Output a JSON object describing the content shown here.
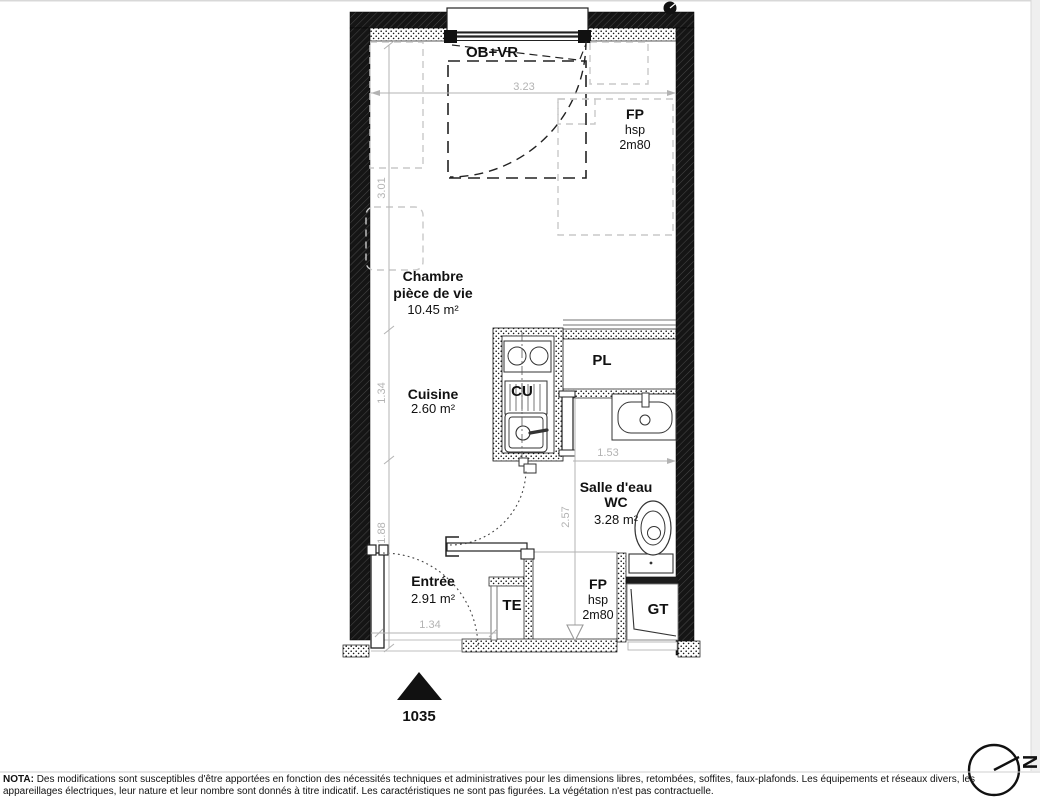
{
  "plan": {
    "unit": {
      "number": "1035"
    },
    "rooms": {
      "chambre": {
        "name": "Chambre",
        "sub": "pièce de vie",
        "area": "10.45 m²"
      },
      "cuisine": {
        "name": "Cuisine",
        "area": "2.60 m²"
      },
      "salle_eau": {
        "name": "Salle d'eau",
        "sub": "WC",
        "area": "3.28 m²"
      },
      "entree": {
        "name": "Entrée",
        "area": "2.91 m²"
      }
    },
    "annotations": {
      "window": "OB+VR",
      "fp": "FP",
      "hsp": "hsp",
      "height": "2m80",
      "pl": "PL",
      "cu": "CU",
      "te": "TE",
      "gt": "GT"
    },
    "dims": {
      "top": "3.23",
      "left_upper": "3.01",
      "left_mid": "1.34",
      "left_lower": "1.88",
      "entree": "1.34",
      "bath_w": "1.53",
      "bath_h": "2.57"
    },
    "compass": {
      "north": "N"
    }
  },
  "footer": {
    "bold": "NOTA:",
    "line1": " Des modifications sont susceptibles d'être apportées en fonction des nécessités techniques et administratives pour les dimensions libres, retombées, soffites, faux-plafonds. Les équipements et réseaux divers, les",
    "line2": "appareillages électriques, leur nature et leur nombre sont donnés à titre indicatif. Les caractéristiques ne sont pas figurées. La végétation n'est pas contractuelle."
  },
  "colors": {
    "wall": "#151515",
    "dim_gray": "#b3b3b3",
    "furniture_gray": "#c9c9c9"
  }
}
